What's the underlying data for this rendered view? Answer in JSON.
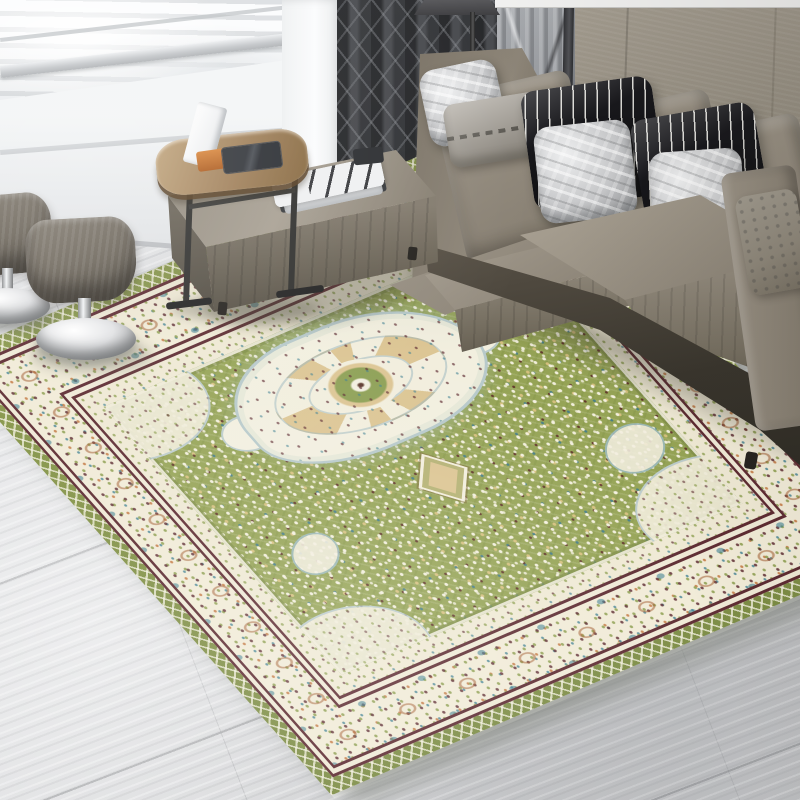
{
  "scene": {
    "type": "product-photograph",
    "setting": "modern living room with bright window light",
    "subject": "oriental medallion area rug in green and cream tones",
    "objects": [
      "green-and-cream medallion area rug",
      "gray leather sectional sofa",
      "black-and-white striped pillows",
      "silver crinkle pillows",
      "gray woven lumbar pillow",
      "leather chaise ottoman",
      "wood side table with tablets",
      "two chrome-base upholstered stools",
      "floor lamp",
      "dark patterned curtain and sheer panel",
      "taupe fabric wall panel",
      "bright window with sill",
      "light gray diagonal wood-plank floor"
    ]
  },
  "palette": {
    "floor": "#d8d9db",
    "wall": "#948d80",
    "curtain": "#3f4145",
    "sheer": "#a9acb0",
    "window": "#f5f6f8",
    "leather": "#8a8275",
    "leather-light": "#a8a093",
    "leather-dark": "#5f584c",
    "stripe-dark": "#17171b",
    "stripe-light": "#dddcd8",
    "silver": "#c7c8ca",
    "rug-green": "#95a355",
    "rug-edge-green": "#879649",
    "rug-cream": "#f1ebd7",
    "rug-maroon": "#5d2b31",
    "rug-tan": "#dcc593",
    "rug-teal": "#3e7f91",
    "rug-orange": "#bf6e34",
    "wood": "#a0805a",
    "chrome": "#f2f4f5",
    "shadow": "#38342c"
  }
}
